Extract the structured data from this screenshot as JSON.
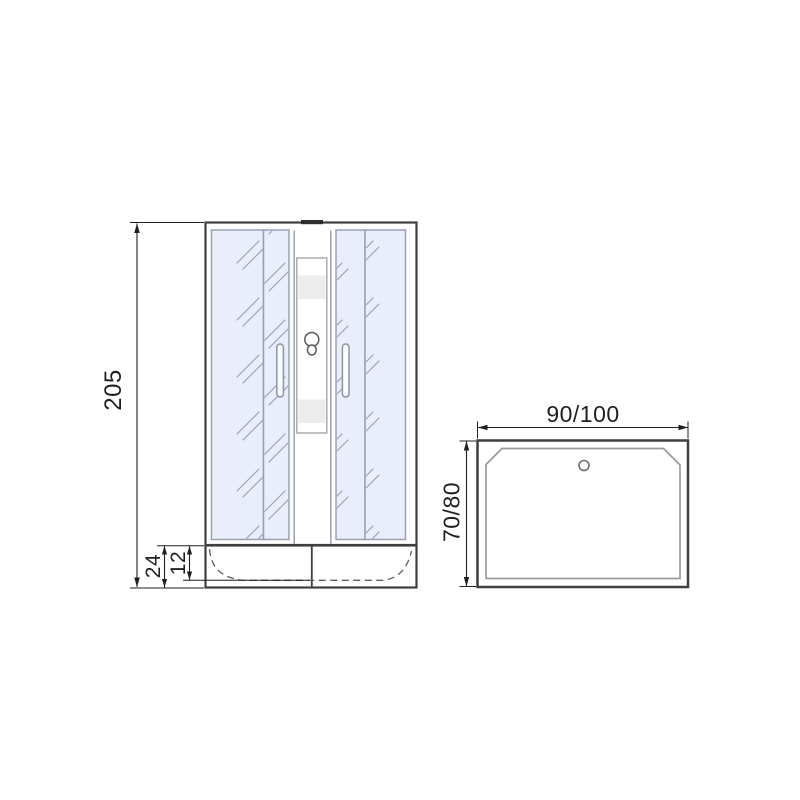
{
  "diagram": {
    "title": "shower-cabin-dimension-drawing",
    "front_view": {
      "height_label": "205",
      "tray_height_label": "24",
      "tray_depth_label": "12"
    },
    "top_view": {
      "width_label": "90/100",
      "depth_label": "70/80"
    },
    "colors": {
      "line": "#3f3f3f",
      "dim": "#1f1f1f",
      "glass_fill": "#e9eefa",
      "glass_border": "#98a0b4",
      "glint": "#93a0c0",
      "band": "#ececec"
    }
  }
}
